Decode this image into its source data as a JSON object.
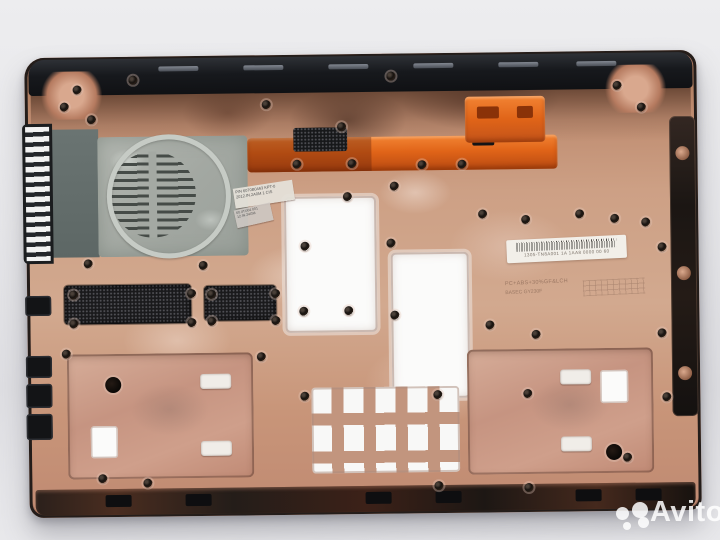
{
  "watermark": {
    "brand": "Avito",
    "color": "#ffffff"
  },
  "stickers": {
    "part_label": {
      "line1": "P/N 6070B0463 KPT-0",
      "line2": "2012.IN.2A0M 1 CIS"
    },
    "serial_label": {
      "line1": "60.4TU04.001",
      "line2": "12.IN.24GM"
    },
    "barcode_label": {
      "text": "1305-TN8A001 1A 1AA8 0000 00 60"
    },
    "molded_marking": {
      "line1": "PC+ABS+30%GF&LCH",
      "line2": "BASEC GY230F"
    }
  },
  "palette": {
    "background": "#e6e6e9",
    "copper": "#c28b73",
    "copper_light": "#d9b3a0",
    "copper_dark": "#7c4f3b",
    "black_trim": "#17191d",
    "orange_part": "#e06418",
    "fan_gray": "#a3a8a2",
    "shroud_gray": "#64706e",
    "cutout_white": "#fbfbfa"
  }
}
